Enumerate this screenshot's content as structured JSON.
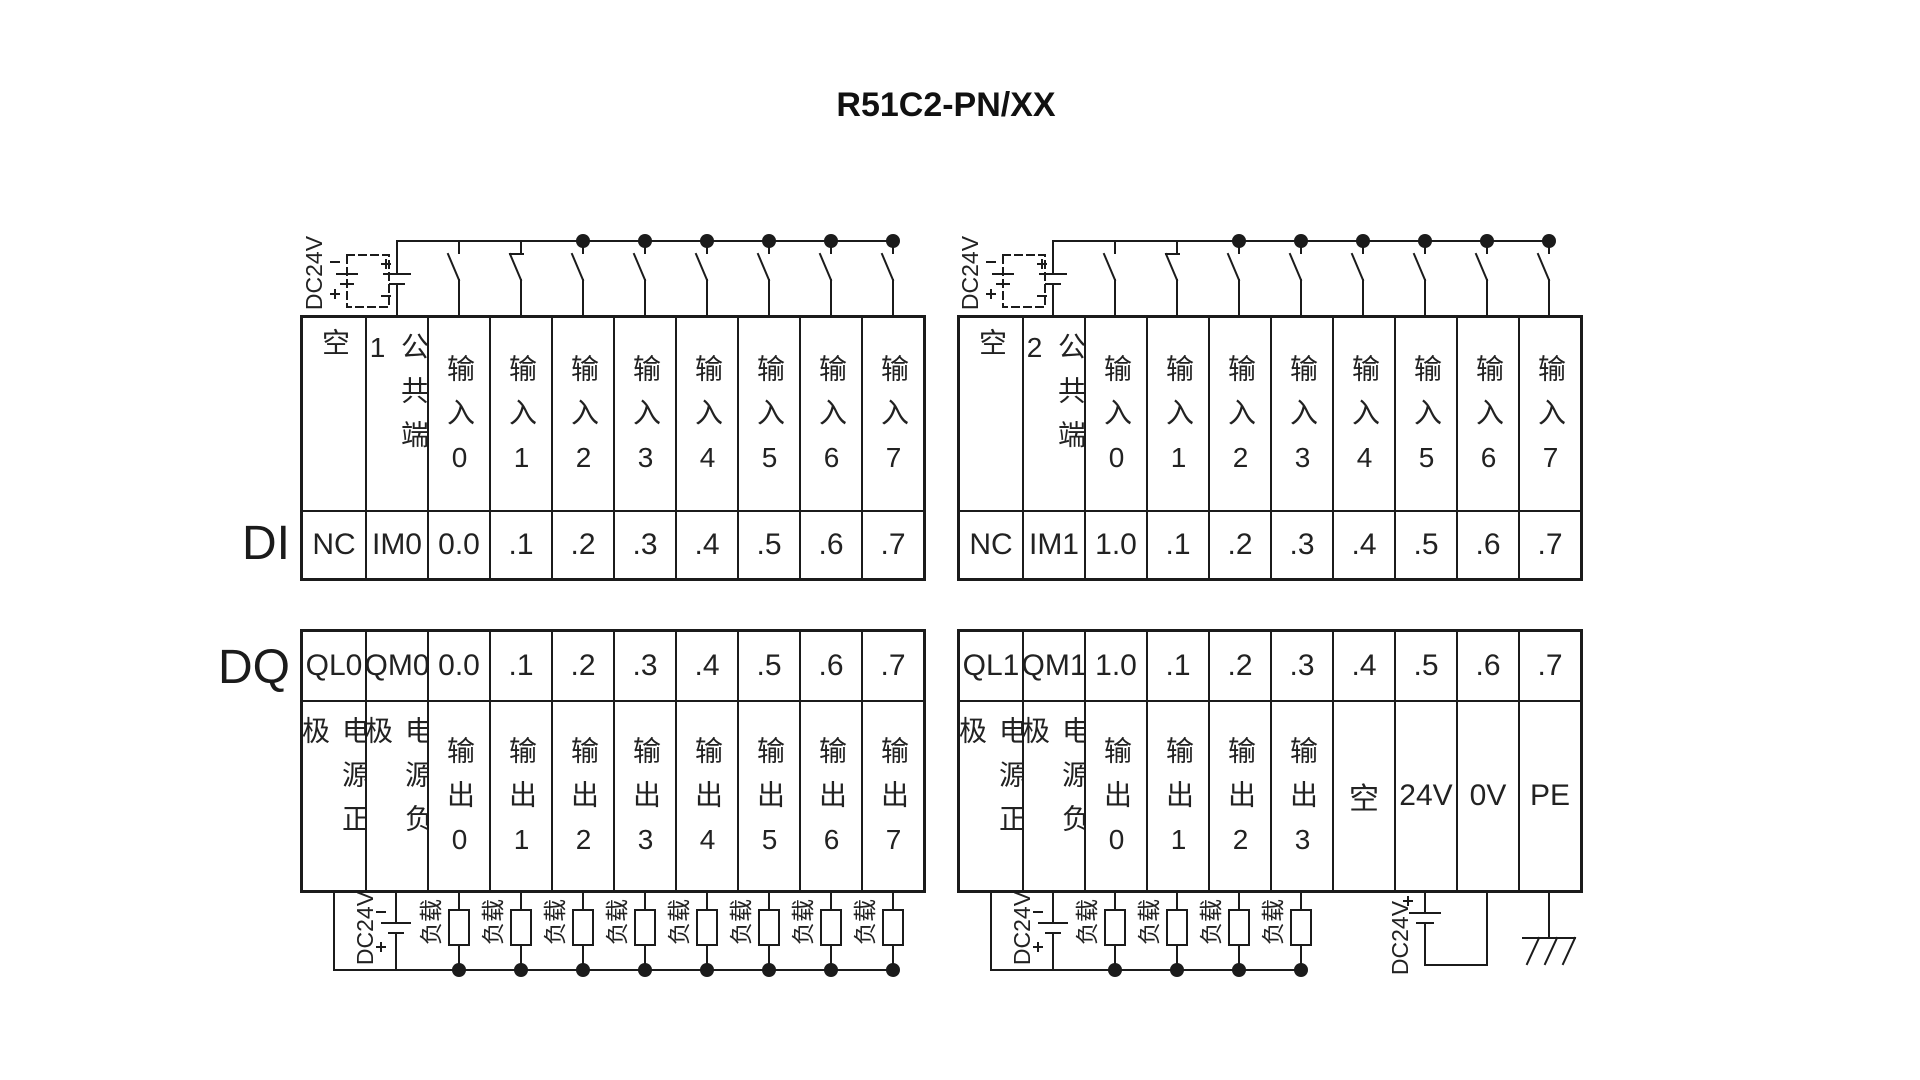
{
  "title": "R51C2-PN/XX",
  "labels": {
    "di": "DI",
    "dq": "DQ",
    "dc24v": "DC24V",
    "load": "负载"
  },
  "di_left": {
    "header": [
      "空",
      "公共端1",
      "输入0",
      "输入1",
      "输入2",
      "输入3",
      "输入4",
      "输入5",
      "输入6",
      "输入7"
    ],
    "pins": [
      "NC",
      "IM0",
      "0.0",
      ".1",
      ".2",
      ".3",
      ".4",
      ".5",
      ".6",
      ".7"
    ]
  },
  "di_right": {
    "header": [
      "空",
      "公共端2",
      "输入0",
      "输入1",
      "输入2",
      "输入3",
      "输入4",
      "输入5",
      "输入6",
      "输入7"
    ],
    "pins": [
      "NC",
      "IM1",
      "1.0",
      ".1",
      ".2",
      ".3",
      ".4",
      ".5",
      ".6",
      ".7"
    ]
  },
  "dq_left": {
    "pins": [
      "QL0",
      "QM0",
      "0.0",
      ".1",
      ".2",
      ".3",
      ".4",
      ".5",
      ".6",
      ".7"
    ],
    "header": [
      "电源正极",
      "电源负极",
      "输出0",
      "输出1",
      "输出2",
      "输出3",
      "输出4",
      "输出5",
      "输出6",
      "输出7"
    ]
  },
  "dq_right": {
    "pins": [
      "QL1",
      "QM1",
      "1.0",
      ".1",
      ".2",
      ".3",
      ".4",
      ".5",
      ".6",
      ".7"
    ],
    "header": [
      "电源正极",
      "电源负极",
      "输出0",
      "输出1",
      "输出2",
      "输出3",
      "空",
      "24V",
      "0V",
      "PE"
    ]
  }
}
